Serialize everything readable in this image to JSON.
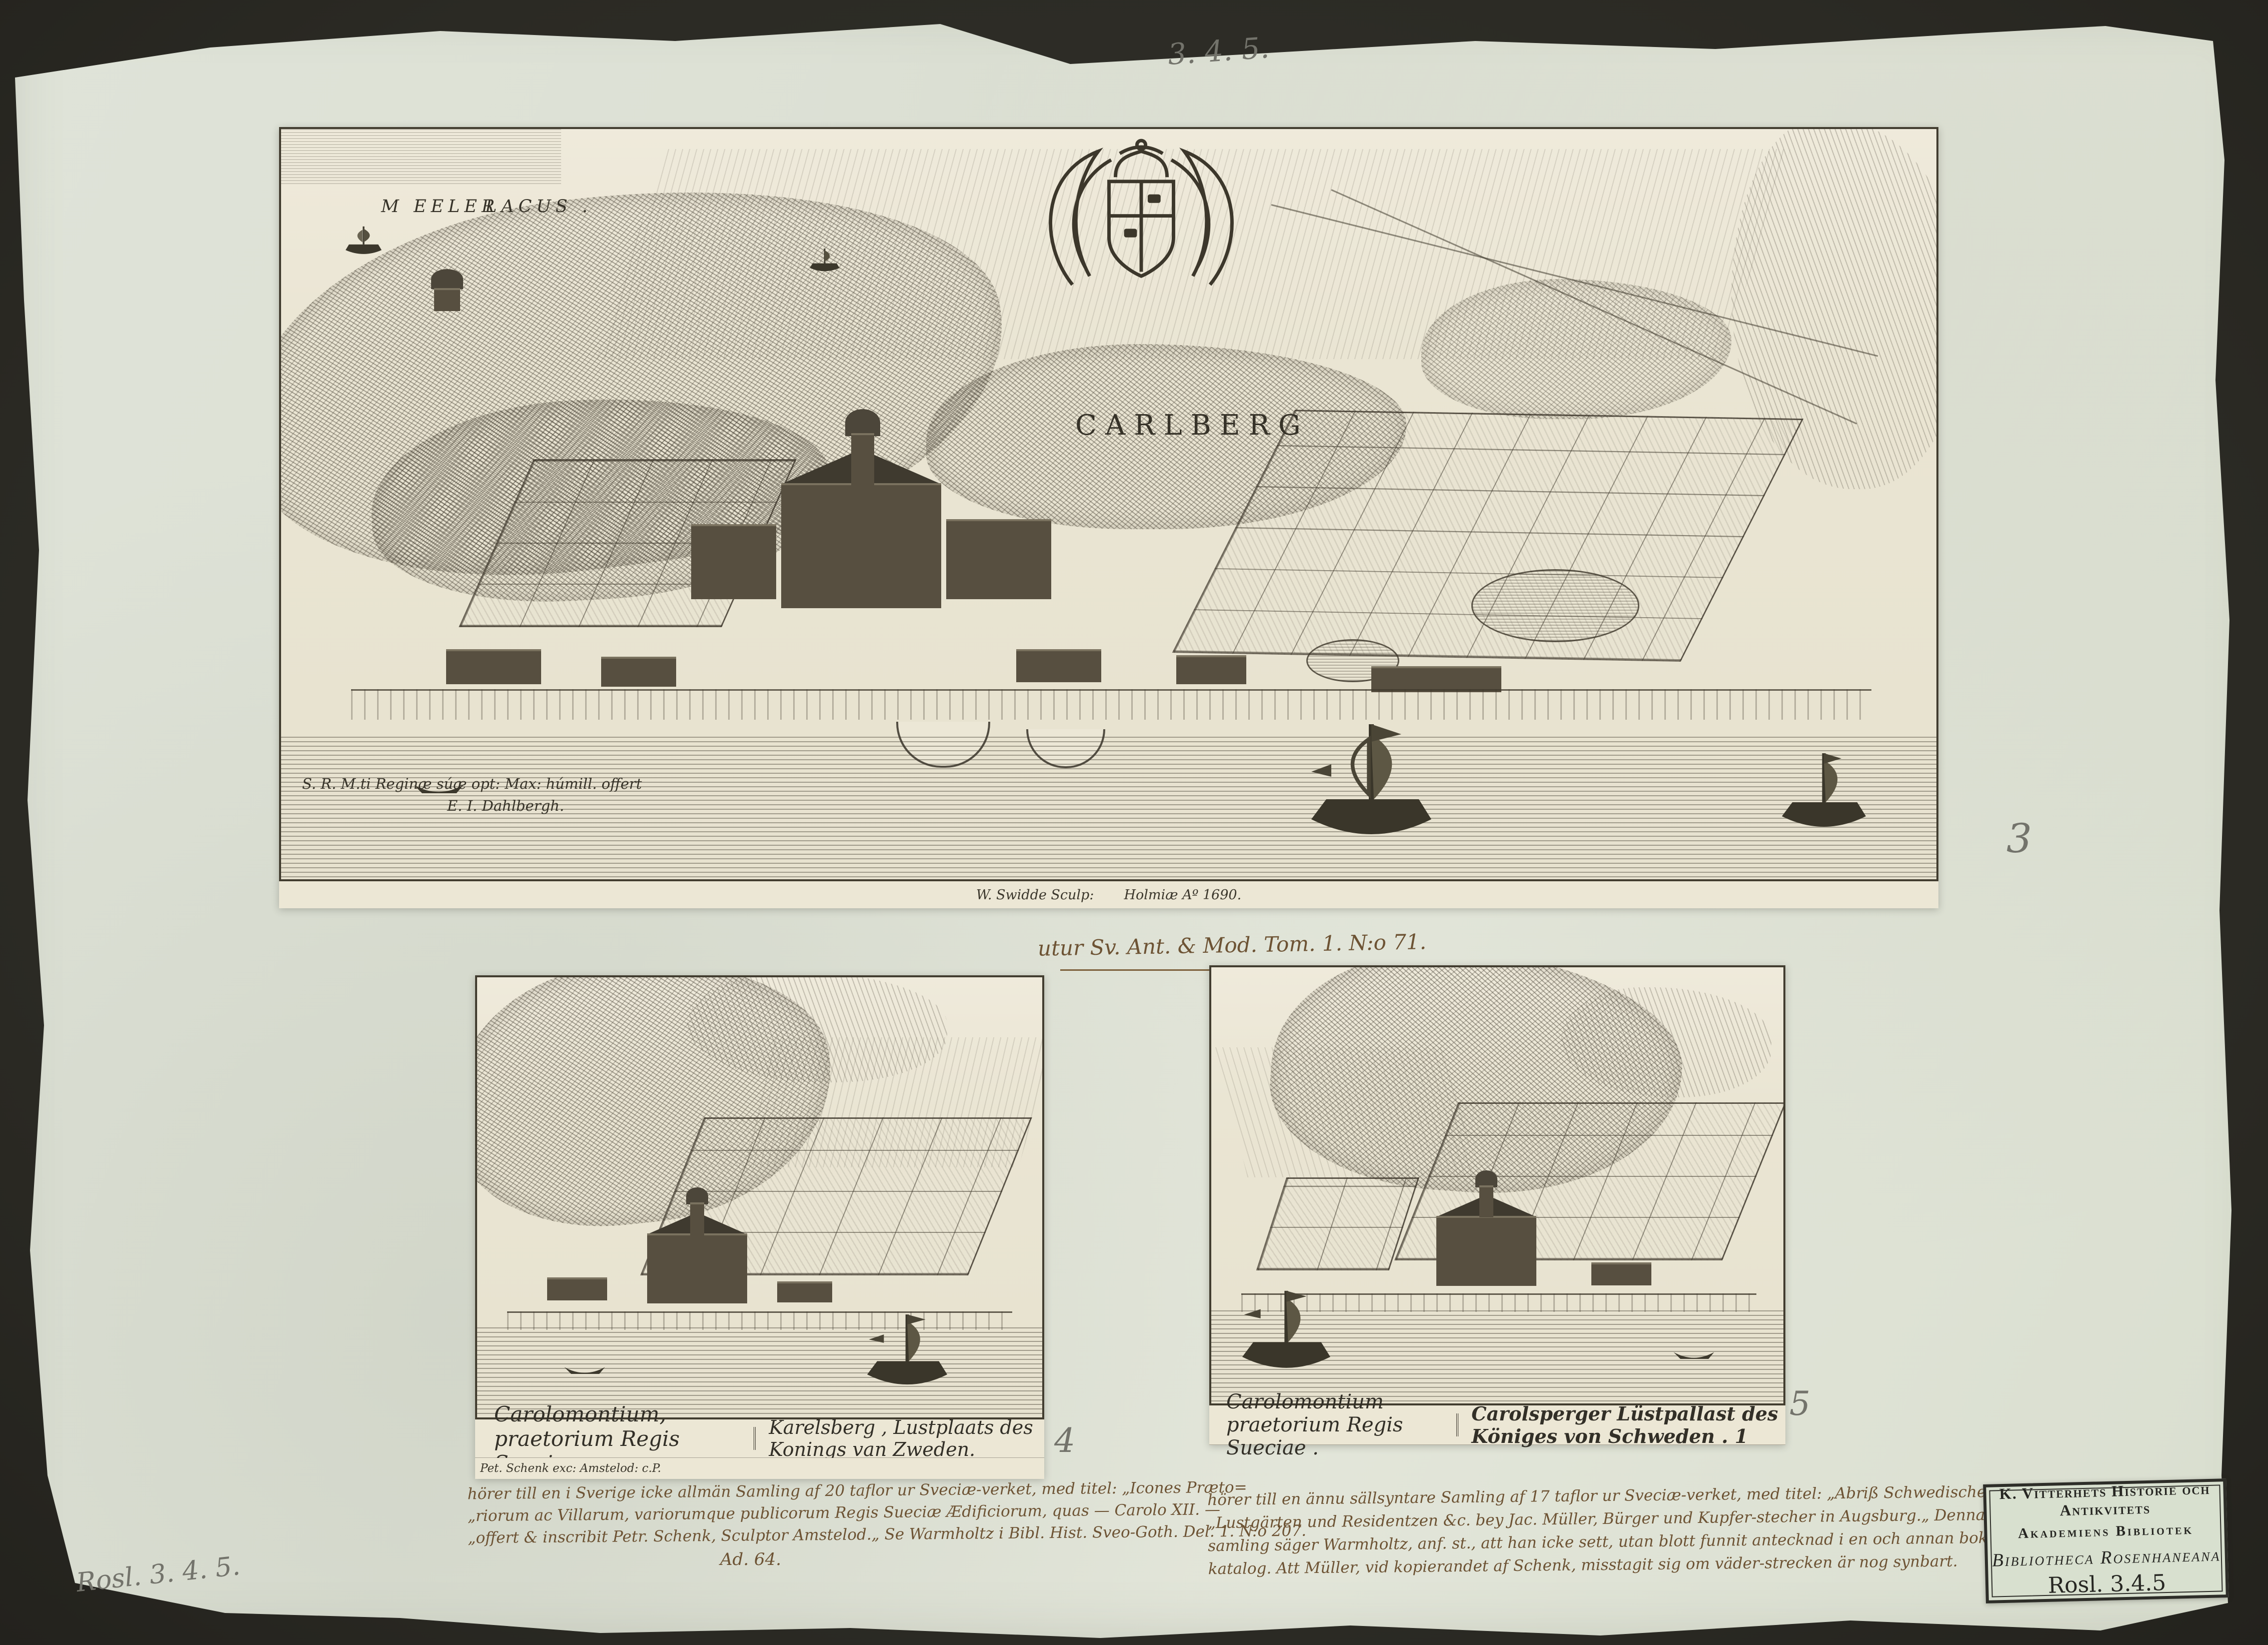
{
  "annotations": {
    "top_shelfmark_pencil": "3. 4. 5.",
    "plate_number_main": "3",
    "plate_number_left": "4",
    "plate_number_right": "5",
    "bottom_shelfmark_pencil": "Rosl. 3. 4. 5.",
    "source_note_main": "utur Sv. Ant. & Mod. Tom. 1. N:o 71."
  },
  "main_plate": {
    "lake_label_word1": "M EELER",
    "lake_label_word2": "LACUS .",
    "cartouche_title": "CARLBERG",
    "dedication_line1": "S. R. M.ti Reginæ súæ opt: Max: húmill. offert",
    "dedication_line2": "E. I. Dahlbergh.",
    "imprint_engraver": "W. Swidde Sculp:",
    "imprint_place": "Holmiæ Aº 1690."
  },
  "left_plate": {
    "caption_latin": "Carolomontium, praetorium Regis Sueciae.",
    "caption_dutch": "Karelsberg , Lustplaats des Konings van Zweden.",
    "imprint": "Pet. Schenk exc: Amstelod: c.P.",
    "note_lines": [
      "hörer till en i Sverige icke allmän Samling af 20 taflor ur Sveciæ-verket, med titel: „Icones Præto=",
      "„riorum ac Villarum, variorumque publicorum Regis Sueciæ Ædificiorum, quas — Carolo XII. —",
      "„offert & inscribit Petr. Schenk, Sculptor Amstelod.„  Se Warmholtz i Bibl. Hist. Sveo-Goth. Del. 1. N:o 207."
    ],
    "note_ref": "Ad. 64."
  },
  "right_plate": {
    "caption_latin": "Carolomontium praetorium Regis Sueciae .",
    "caption_german": "Carolsperger Lüstpallast des Königes von Schweden . 1",
    "note_lines": [
      "hörer till en ännu sällsyntare Samling af 17 taflor ur Sveciæ-verket, med titel: „Abriß Schwedischer",
      "„Lustgärten und Residentzen &c. bey Jac. Müller, Bürger und Kupfer-stecher in Augsburg.„ Denna",
      "samling säger Warmholtz, anf. st., att han icke sett, utan blott funnit antecknad i en och annan bok=",
      "katalog. Att Müller, vid kopierandet af Schenk, misstagit sig om väder-strecken är nog synbart."
    ]
  },
  "stamp": {
    "line1": "K. Vitterhets Historie och Antikvitets",
    "line2": "Akademiens Bibliotek",
    "line3": "Bibliotheca Rosenhaneana",
    "shelfmark": "Rosl. 3.4.5"
  }
}
